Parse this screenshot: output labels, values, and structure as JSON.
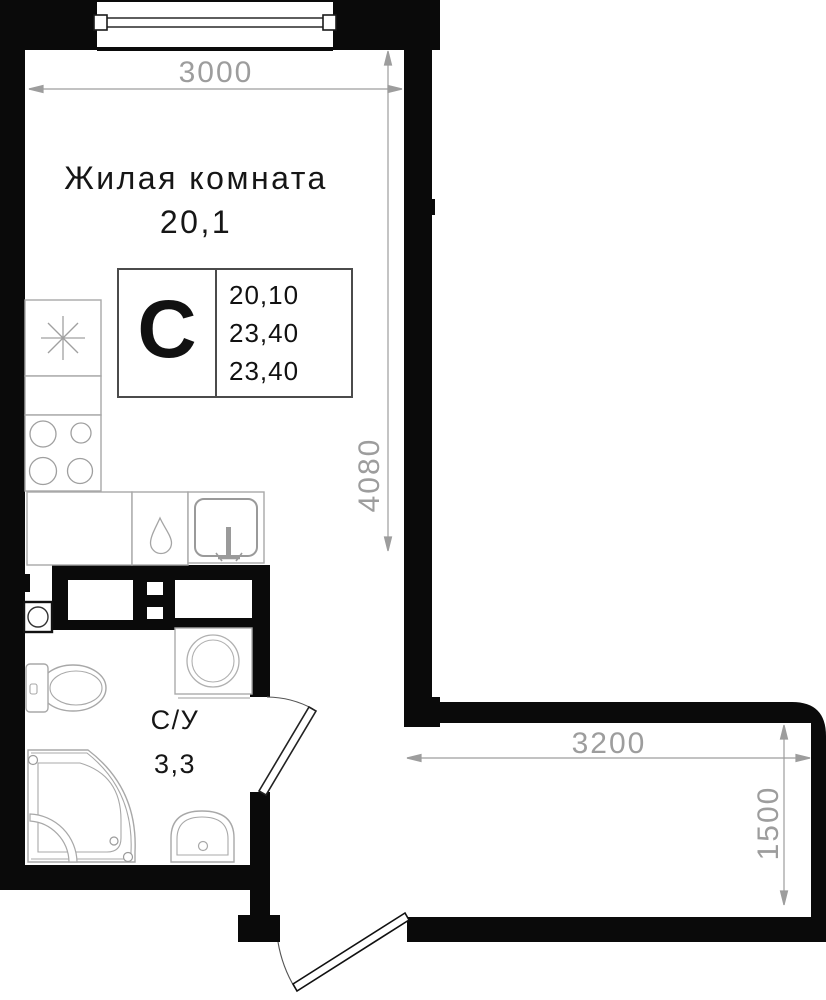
{
  "plan": {
    "background": "#ffffff",
    "colors": {
      "wall": "#0a0a0a",
      "fixture_stroke": "#a8a8a8",
      "dimension": "#9d9d9d",
      "text": "#1c1c1c"
    },
    "living_room": {
      "label": "Жилая комната",
      "area": "20,1"
    },
    "bathroom": {
      "label": "С/У",
      "area": "3,3"
    },
    "unit_stamp": {
      "letter": "С",
      "rows": [
        "20,10",
        "23,40",
        "23,40"
      ]
    },
    "dimensions": {
      "room_width": "3000",
      "room_height": "4080",
      "corridor_width": "3200",
      "corridor_depth": "1500"
    },
    "fixtures": [
      "window",
      "refrigerator",
      "stove",
      "kitchen-counter",
      "water-drop",
      "kitchen-sink",
      "vent-shaft",
      "toilet",
      "washing-machine",
      "shower-cabin",
      "washbasin",
      "bath-door",
      "entrance-door"
    ]
  }
}
